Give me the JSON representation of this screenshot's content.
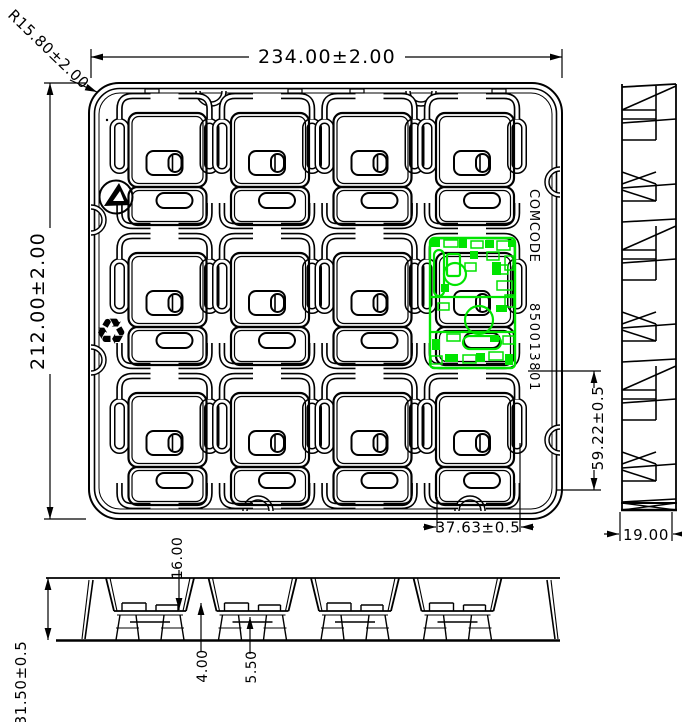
{
  "drawing": {
    "type": "engineering-drawing",
    "views": [
      "top view",
      "right side view",
      "front section view"
    ],
    "grid": {
      "rows": 3,
      "cols": 4
    },
    "pcb_position": {
      "row": 2,
      "col": 4
    }
  },
  "dimensions": {
    "overall_width": "234.00±2.00",
    "overall_height": "212.00±2.00",
    "corner_radius": "R15.80±2.00",
    "pcb_vertical": "59.22±0.5",
    "pcb_horizontal": "37.63±0.5",
    "side_width": "19.00",
    "overall_depth": "31.50±0.5",
    "pocket_depth": "16.00",
    "step_a": "4.00",
    "step_b": "5.50"
  },
  "labels": {
    "comcode": "COMCODE",
    "comcode_number": "850013801"
  },
  "icons": {
    "recycle_char": "♻"
  },
  "colors": {
    "line": "#000000",
    "pcb": "#00E400",
    "background": "#FFFFFF"
  }
}
